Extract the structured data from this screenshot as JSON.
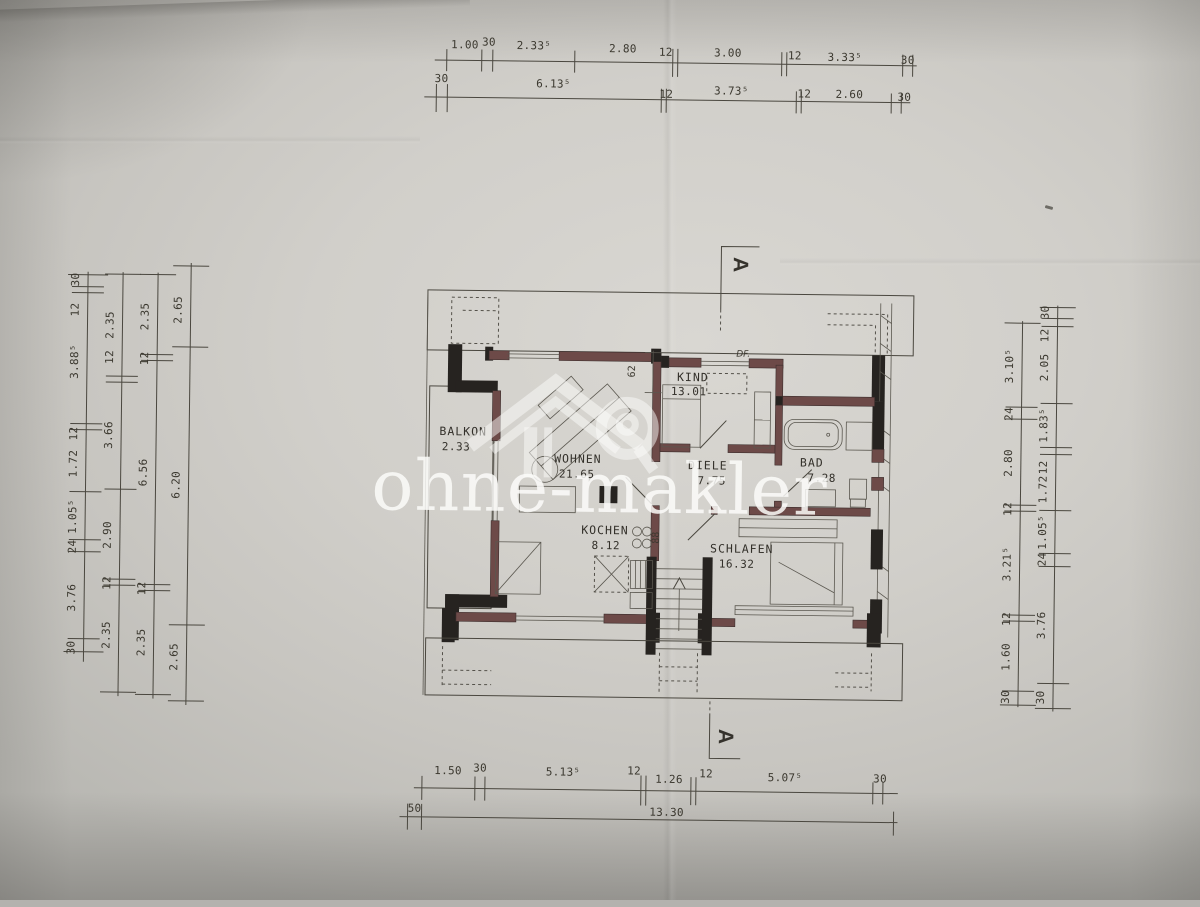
{
  "watermark": {
    "brand": "ohne-makler"
  },
  "plan": {
    "rooms": [
      {
        "id": "balkon",
        "name": "BALKON",
        "area": "2.33"
      },
      {
        "id": "wohnen",
        "name": "WOHNEN",
        "area": "21.65"
      },
      {
        "id": "kochen",
        "name": "KOCHEN",
        "area": "8.12"
      },
      {
        "id": "kind",
        "name": "KIND",
        "area": "13.01"
      },
      {
        "id": "diele",
        "name": "DIELE",
        "area": "7.75"
      },
      {
        "id": "bad",
        "name": "BAD",
        "area": "7.28"
      },
      {
        "id": "schlafen",
        "name": "SCHLAFEN",
        "area": "16.32"
      }
    ],
    "annotations": {
      "roof_window": "DF.",
      "section_marker": "A",
      "dim_62": "62",
      "dim_88": "88"
    }
  },
  "dims": {
    "top1": [
      "1.00",
      "30",
      "2.33⁵",
      "2.80",
      "12",
      "3.00",
      "12",
      "3.33⁵",
      "30"
    ],
    "top2": [
      "30",
      "6.13⁵",
      "12",
      "3.73⁵",
      "12",
      "2.60",
      "30"
    ],
    "bottom1": [
      "1.50",
      "30",
      "5.13⁵",
      "12",
      "1.26",
      "12",
      "5.07⁵",
      "30"
    ],
    "bottom2": [
      "50",
      "13.30"
    ],
    "left1": [
      "30",
      "12",
      "3.88⁵",
      "12",
      "1.72",
      "1.05⁵",
      "24",
      "3.76",
      "30"
    ],
    "left2": [
      "2.35",
      "12",
      "3.66",
      "2.90",
      "12",
      "2.35"
    ],
    "left3": [
      "2.35",
      "12",
      "6.56",
      "12",
      "2.35"
    ],
    "left4": [
      "2.65",
      "6.20",
      "2.65"
    ],
    "right_inner": [
      "3.10⁵",
      "24",
      "2.80",
      "12",
      "3.21⁵",
      "12",
      "1.60",
      "30"
    ],
    "right_outer": [
      "30",
      "12",
      "2.05",
      "1.83⁵",
      "12",
      "1.72",
      "1.05⁵",
      "24",
      "3.76",
      "30"
    ]
  }
}
